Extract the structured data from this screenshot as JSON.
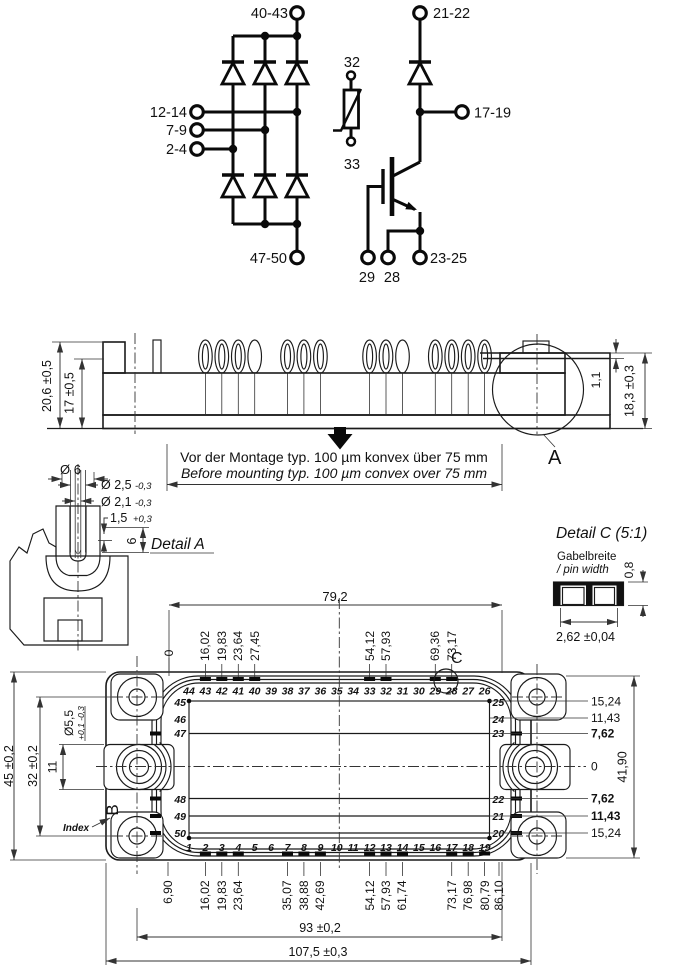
{
  "schematic": {
    "rectifier": {
      "dc_plus": "40-43",
      "ac_inputs": [
        "12-14",
        "7-9",
        "2-4"
      ],
      "dc_minus": "47-50"
    },
    "thermistor": {
      "pin_top": "32",
      "pin_bottom": "33"
    },
    "igbt": {
      "collector": "21-22",
      "aux_collector": "17-19",
      "emitter": "23-25",
      "gate": "29",
      "aux_emitter": "28"
    }
  },
  "side_view": {
    "dim_total": "20,6 ±0,5",
    "dim_inner": "17 ±0,5",
    "dim_step": "1,1",
    "dim_right": "18,3 ±0,3",
    "detail_ref": "A",
    "note_de": "Vor der Montage typ. 100 µm konvex über 75 mm",
    "note_en": "Before mounting typ. 100 µm convex over 75 mm"
  },
  "detail_a": {
    "title": "Detail A",
    "d6": "Ø 6",
    "d25": "Ø 2,5",
    "d25_tol": "-0,3",
    "d21": "Ø 2,1",
    "d21_tol": "-0,3",
    "depth": "1,5",
    "depth_tol": "+0,3",
    "len6": "6"
  },
  "detail_c": {
    "title": "Detail C (5:1)",
    "caption_de": "Gabelbreite",
    "caption_en": "/ pin width",
    "thickness": "0,8",
    "width": "2,62 ±0,04"
  },
  "bottom_view": {
    "pins_top": [
      "44",
      "43",
      "42",
      "41",
      "40",
      "39",
      "38",
      "37",
      "36",
      "35",
      "34",
      "33",
      "32",
      "31",
      "30",
      "29",
      "28",
      "27",
      "26"
    ],
    "pins_bottom": [
      "1",
      "2",
      "3",
      "4",
      "5",
      "6",
      "7",
      "8",
      "9",
      "10",
      "11",
      "12",
      "13",
      "14",
      "15",
      "16",
      "17",
      "18",
      "19"
    ],
    "pins_left": [
      "45",
      "46",
      "47",
      "48",
      "49",
      "50"
    ],
    "pins_right": [
      "25",
      "24",
      "23",
      "22",
      "21",
      "20"
    ],
    "dims_top": [
      "16,02",
      "19,83",
      "23,64",
      "27,45",
      "54,12",
      "57,93",
      "69,36",
      "73,17"
    ],
    "dims_bottom": [
      "6,90",
      "16,02",
      "19,83",
      "23,64",
      "35,07",
      "38,88",
      "42,69",
      "54,12",
      "57,93",
      "61,74",
      "73,17",
      "76,98",
      "80,79",
      "86,10"
    ],
    "dims_right": [
      "15,24",
      "11,43",
      "7,62",
      "0",
      "7,62",
      "11,43",
      "15,24"
    ],
    "dim_top_span": "79,2",
    "dim_total_height": "41,90",
    "dim_outline_height": "45 ±0,2",
    "dim_hole_pitch_v": "32 ±0,2",
    "dim_fork": "11",
    "dim_hole": "Ø5,5",
    "dim_hole_tol": "+0,1 -0,3",
    "datum_zero": "0",
    "label_index": "Index",
    "corner_ref": "B",
    "detail_ref": "C",
    "dim_hole_pitch_h": "93 ±0,2",
    "dim_total_width": "107,5 ±0,3"
  }
}
